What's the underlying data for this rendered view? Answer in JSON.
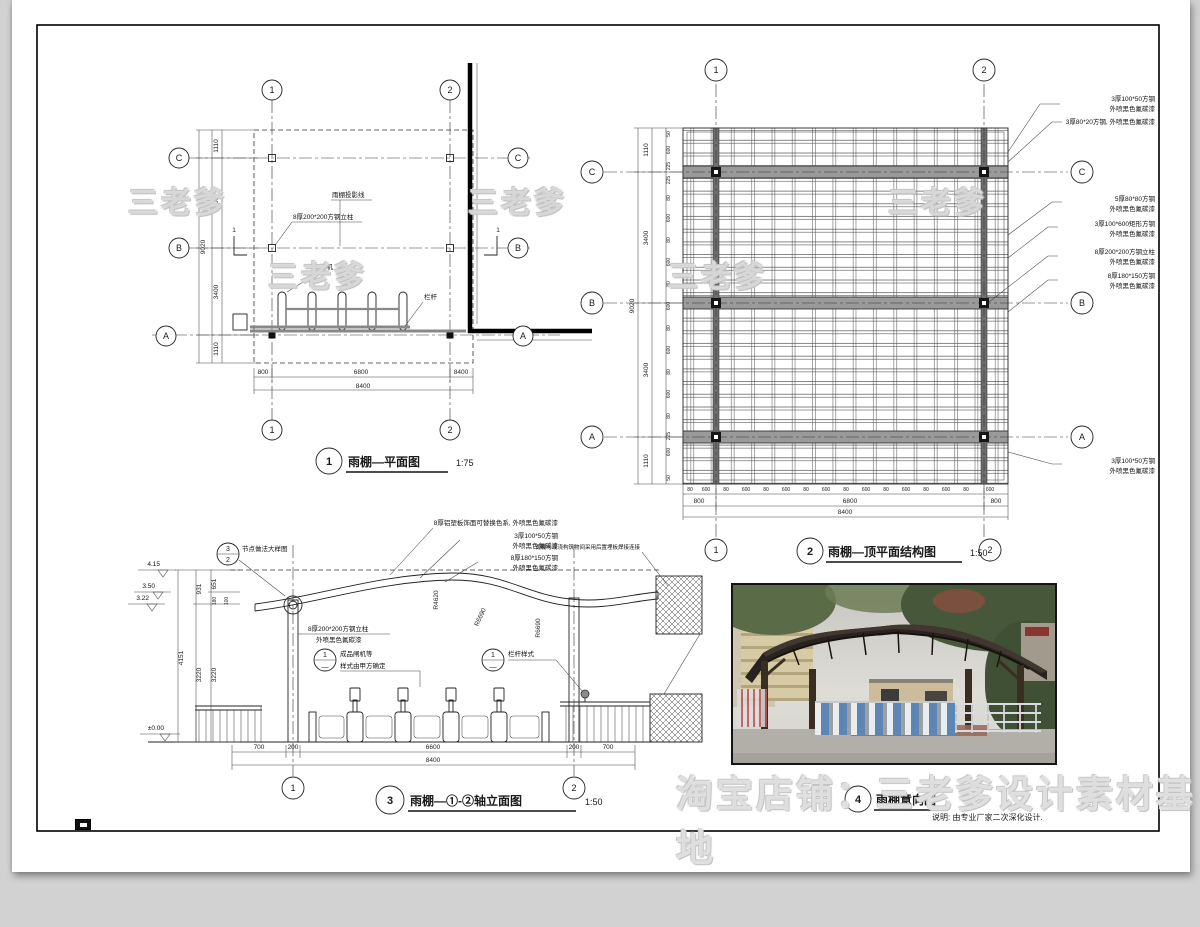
{
  "sheet": {
    "watermark_store": "淘宝店铺：三老爹设计素材基地",
    "watermark_brand": "三老爹",
    "note": "说明: 由专业厂家二次深化设计."
  },
  "axes": {
    "n1": "1",
    "n2": "2",
    "A": "A",
    "B": "B",
    "C": "C"
  },
  "plan1": {
    "ref_num": "1",
    "title": "雨棚—平面图",
    "scale": "1:75",
    "label_projection": "雨棚投影线",
    "label_column": "8厚200*200方钢立柱",
    "label_turnstile": "闸机",
    "label_railing": "栏杆",
    "section_mark": "1",
    "dim_1110": "1110",
    "dim_3400": "3400",
    "dim_9020": "9020",
    "dim_800": "800",
    "dim_6800": "6800",
    "dim_8400": "8400"
  },
  "plan2": {
    "ref_num": "2",
    "title": "雨棚—顶平面结构图",
    "scale": "1:50",
    "ann1a": "3厚100*50方钢",
    "ann1b": "外喷黑色氟碳漆",
    "ann2": "3厚80*20方钢, 外喷黑色氟碳漆",
    "ann3a": "5厚80*80方钢",
    "ann3b": "外喷黑色氟碳漆",
    "ann4a": "3厚100*600矩形方钢",
    "ann4b": "外喷黑色氟碳漆",
    "ann5a": "8厚200*200方钢立柱",
    "ann5b": "外喷黑色氟碳漆",
    "ann6a": "8厚180*150方钢",
    "ann6b": "外喷黑色氟碳漆",
    "ann7a": "3厚100*50方钢",
    "ann7b": "外喷黑色氟碳漆",
    "dim_1110": "1110",
    "dim_3400": "3400",
    "dim_9020": "9020",
    "dim_800": "800",
    "dim_6800": "6800",
    "dim_8400": "8400",
    "dim_600": "600",
    "dim_80": "80",
    "dim_225": "225",
    "dim_50": "50"
  },
  "elev3": {
    "ref_num": "3",
    "title": "雨棚—①-②轴立面图",
    "scale": "1:50",
    "callout_node": "节点做法大样图",
    "node_top": "3",
    "node_bottom": "2",
    "lbl_roof": "8厚铝塑板饰面可替换色系, 外喷黑色氟碳漆",
    "lbl_steel1a": "3厚100*50方钢",
    "lbl_steel1b": "外喷黑色氟碳漆",
    "lbl_steel2a": "8厚180*150方钢",
    "lbl_steel2b": "外喷黑色氟碳漆",
    "lbl_conn": "雨棚与现浇构筑物间采用后置埋板焊接连接",
    "lbl_col_a": "8厚200*200方钢立柱",
    "lbl_col_b": "外喷黑色氟碳漆",
    "detail_top": "1",
    "detail_bottom": "—",
    "lbl_gate_a": "成品闸机等",
    "lbl_gate_b": "样式由甲方确定",
    "lbl_rail": "栏杆样式",
    "lv_415": "4.15",
    "lv_350": "3.50",
    "lv_322": "3.22",
    "lv_000": "±0.00",
    "d_931": "931",
    "d_651": "651",
    "d_180": "180",
    "d_100": "100",
    "d_4151": "4151",
    "d_3220": "3220",
    "d_700": "700",
    "d_200": "200",
    "d_6600": "6600",
    "d_8400": "8400",
    "r_4620": "R4620",
    "r_6690": "R6690"
  },
  "view4": {
    "ref_num": "4",
    "title": "雨棚意向图"
  }
}
